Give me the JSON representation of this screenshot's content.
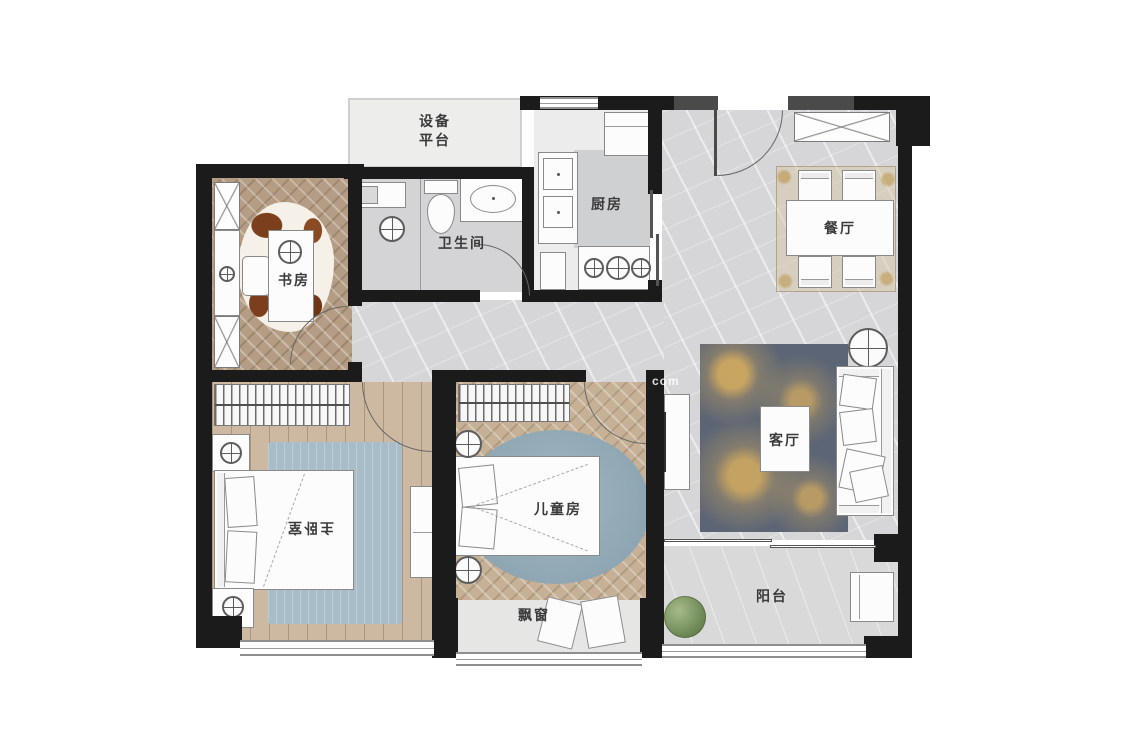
{
  "plan": {
    "type": "apartment-floor-plan",
    "rooms": {
      "equipment_platform": {
        "label": "设备\n平台"
      },
      "study": {
        "label": "书房"
      },
      "bathroom": {
        "label": "卫生间"
      },
      "kitchen": {
        "label": "厨房"
      },
      "dining": {
        "label": "餐厅"
      },
      "living": {
        "label": "客厅"
      },
      "master_bedroom": {
        "label": "主卧室"
      },
      "kids_room": {
        "label": "儿童房"
      },
      "bay_window": {
        "label": "飘窗"
      },
      "balcony": {
        "label": "阳台"
      }
    },
    "watermark": {
      "text": "com"
    },
    "colors": {
      "wall": "#1b1b1b",
      "partition_wall": "#4a4a4a",
      "marble_floor": "#d6d6d8",
      "study_wood": "#b49d84",
      "kids_wood": "#c6b197",
      "master_wood": "#cdb8a2",
      "living_rug": "#5c6575",
      "rug_gold": "#cea860",
      "master_rug": "#a9bdc9",
      "kids_rug": "#8ea6b3",
      "plant": "#6f8a57"
    }
  }
}
